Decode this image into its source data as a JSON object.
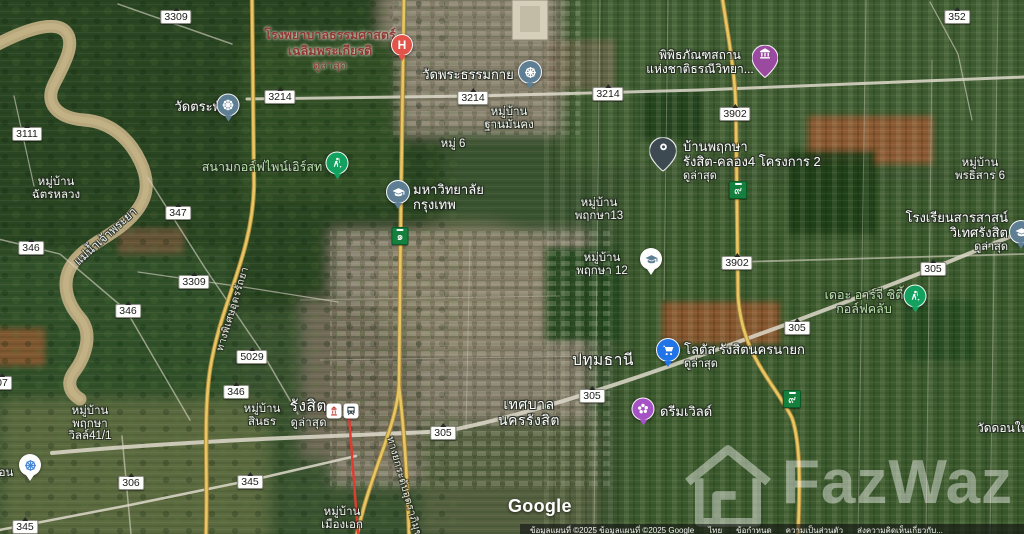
{
  "watermark": {
    "text": "FazWaz",
    "icon": "house-icon"
  },
  "attribution": {
    "logo": "Google",
    "items": [
      {
        "text": "ข้อมูลแผนที่ ©2025 ข้อมูลแผนที่ ©2025 Google",
        "link": false
      },
      {
        "text": "ไทย",
        "link": true
      },
      {
        "text": "ข้อกำหนด",
        "link": true
      },
      {
        "text": "ความเป็นส่วนตัว",
        "link": true
      },
      {
        "text": "ส่งความคิดเห็นเกี่ยวกับ...",
        "link": true
      }
    ]
  },
  "road_shields": [
    {
      "value": "3309",
      "x": 176,
      "y": 17,
      "style": "white"
    },
    {
      "value": "352",
      "x": 957,
      "y": 17,
      "style": "white"
    },
    {
      "value": "3214",
      "x": 280,
      "y": 97,
      "style": "white"
    },
    {
      "value": "3214",
      "x": 473,
      "y": 98,
      "style": "white"
    },
    {
      "value": "3214",
      "x": 608,
      "y": 94,
      "style": "white"
    },
    {
      "value": "3902",
      "x": 735,
      "y": 114,
      "style": "white"
    },
    {
      "value": "3111",
      "x": 27,
      "y": 134,
      "style": "white"
    },
    {
      "value": "๙",
      "x": 738,
      "y": 190,
      "style": "green"
    },
    {
      "value": "347",
      "x": 178,
      "y": 213,
      "style": "white"
    },
    {
      "value": "๑",
      "x": 400,
      "y": 236,
      "style": "green"
    },
    {
      "value": "346",
      "x": 31,
      "y": 248,
      "style": "white"
    },
    {
      "value": "3902",
      "x": 737,
      "y": 263,
      "style": "white"
    },
    {
      "value": "305",
      "x": 933,
      "y": 269,
      "style": "white"
    },
    {
      "value": "3309",
      "x": 194,
      "y": 282,
      "style": "white"
    },
    {
      "value": "346",
      "x": 128,
      "y": 311,
      "style": "white"
    },
    {
      "value": "305",
      "x": 797,
      "y": 328,
      "style": "white"
    },
    {
      "value": "5029",
      "x": 252,
      "y": 357,
      "style": "white"
    },
    {
      "value": "07",
      "x": 2,
      "y": 383,
      "style": "white"
    },
    {
      "value": "346",
      "x": 236,
      "y": 392,
      "style": "white"
    },
    {
      "value": "305",
      "x": 592,
      "y": 396,
      "style": "white"
    },
    {
      "value": "๙",
      "x": 792,
      "y": 399,
      "style": "green"
    },
    {
      "value": "305",
      "x": 443,
      "y": 433,
      "style": "white"
    },
    {
      "value": "306",
      "x": 131,
      "y": 483,
      "style": "white"
    },
    {
      "value": "345",
      "x": 250,
      "y": 482,
      "style": "white"
    },
    {
      "value": "345",
      "x": 25,
      "y": 527,
      "style": "white"
    }
  ],
  "markers": [
    {
      "id": "hospital-marker",
      "icon": "hospital-h-icon",
      "shape": "circle",
      "color": "#e25449",
      "icon_color": "#ffffff",
      "x": 402,
      "y": 45,
      "size": 20
    },
    {
      "id": "museum-marker",
      "icon": "museum-icon",
      "shape": "pin",
      "color": "#9a4ba0",
      "icon_color": "#ffffff",
      "x": 765,
      "y": 60,
      "size": 26
    },
    {
      "id": "dhammakaya-temple-marker",
      "icon": "dharma-wheel-icon",
      "shape": "circle",
      "color": "#5e7f93",
      "icon_color": "#ffffff",
      "x": 530,
      "y": 72,
      "size": 22
    },
    {
      "id": "wat-trapang-marker",
      "icon": "dharma-wheel-icon",
      "shape": "circle",
      "color": "#5e7f93",
      "icon_color": "#ffffff",
      "x": 228,
      "y": 105,
      "size": 21
    },
    {
      "id": "baan-pruksa-pin-marker",
      "icon": "ring-icon",
      "shape": "pin",
      "color": "#3e4a52",
      "icon_color": "#ffffff",
      "x": 663,
      "y": 153,
      "size": 27
    },
    {
      "id": "pinehurst-golf-marker",
      "icon": "golfer-icon",
      "shape": "circle",
      "color": "#12a15e",
      "icon_color": "#ffffff",
      "x": 337,
      "y": 163,
      "size": 21
    },
    {
      "id": "bangkok-university-marker",
      "icon": "graduation-cap-icon",
      "shape": "circle",
      "color": "#5e7f93",
      "icon_color": "#ffffff",
      "x": 398,
      "y": 192,
      "size": 22
    },
    {
      "id": "sarasas-school-marker",
      "icon": "graduation-cap-icon",
      "shape": "circle",
      "color": "#5e7f93",
      "icon_color": "#ffffff",
      "x": 1021,
      "y": 232,
      "size": 22
    },
    {
      "id": "pruksa12-school-marker",
      "icon": "graduation-cap-icon",
      "shape": "circle",
      "color": "#ffffff",
      "icon_color": "#5e7f93",
      "x": 651,
      "y": 259,
      "size": 20
    },
    {
      "id": "rg-city-golf-marker",
      "icon": "golfer-icon",
      "shape": "circle",
      "color": "#12a15e",
      "icon_color": "#ffffff",
      "x": 915,
      "y": 296,
      "size": 21
    },
    {
      "id": "lotus-marker",
      "icon": "cart-icon",
      "shape": "circle",
      "color": "#2173e8",
      "icon_color": "#ffffff",
      "x": 668,
      "y": 350,
      "size": 22
    },
    {
      "id": "dream-world-marker",
      "icon": "flower-icon",
      "shape": "circle",
      "color": "#a552c5",
      "icon_color": "#ffffff",
      "x": 643,
      "y": 409,
      "size": 21
    },
    {
      "id": "rangsit-shrine-marker",
      "icon": "shrine-icon",
      "shape": "square",
      "color": "#ffffff",
      "icon_color": "#c0392b",
      "x": 334,
      "y": 411,
      "size": 15
    },
    {
      "id": "rangsit-station-marker",
      "icon": "train-icon",
      "shape": "square",
      "color": "#ffffff",
      "icon_color": "#37474f",
      "x": 351,
      "y": 411,
      "size": 15
    },
    {
      "id": "wat-left-edge-marker",
      "icon": "dharma-wheel-icon",
      "shape": "circle",
      "color": "#ffffff",
      "icon_color": "#4a87d5",
      "x": 30,
      "y": 465,
      "size": 20
    }
  ],
  "labels": [
    {
      "id": "thammasat-hospital",
      "type": "hospital",
      "x": 330,
      "y": 28,
      "align": "center",
      "lines": [
        "โรงพยาบาลธรรมศาสตร์",
        "เฉลิมพระเกียรติ"
      ],
      "sub": "ดูล่าสุด",
      "interactable": true
    },
    {
      "id": "geology-museum",
      "type": "poi",
      "x": 700,
      "y": 49,
      "align": "center",
      "lines": [
        "พิพิธภัณฑสถาน",
        "แห่งชาติธรณีวิทยา..."
      ],
      "interactable": true
    },
    {
      "id": "wat-phra-dhammakaya",
      "type": "poi13",
      "x": 468,
      "y": 67,
      "align": "center",
      "lines": [
        "วัดพระธรรมกาย"
      ],
      "interactable": true
    },
    {
      "id": "wat-trapang",
      "type": "poi13",
      "x": 201,
      "y": 99,
      "align": "center",
      "lines": [
        "วัดตระพัง"
      ],
      "interactable": true
    },
    {
      "id": "baan-than-mankong",
      "type": "village",
      "x": 509,
      "y": 106,
      "align": "center",
      "lines": [
        "หมู่บ้าน",
        "ฐานมั่นคง"
      ],
      "interactable": false
    },
    {
      "id": "moo-6",
      "type": "village",
      "x": 453,
      "y": 138,
      "align": "center",
      "lines": [
        "หมู่ 6"
      ],
      "interactable": false
    },
    {
      "id": "baan-pruksa-rangsit",
      "type": "poi13",
      "x": 683,
      "y": 139,
      "align": "left",
      "lines": [
        "บ้านพฤกษา",
        "รังสิต-คลอง4 โครงการ 2"
      ],
      "sub": "ดูล่าสุด",
      "interactable": true
    },
    {
      "id": "pornthisan-6",
      "type": "village",
      "x": 980,
      "y": 157,
      "align": "center",
      "lines": [
        "หมู่บ้าน",
        "พรธิสาร 6"
      ],
      "interactable": false
    },
    {
      "id": "pinehurst-golf",
      "type": "golf",
      "x": 262,
      "y": 160,
      "align": "center",
      "lines": [
        "สนามกอล์ฟไพน์เอิร์สท"
      ],
      "interactable": true
    },
    {
      "id": "chat-luang",
      "type": "village",
      "x": 56,
      "y": 176,
      "align": "center",
      "lines": [
        "หมู่บ้าน",
        "ฉัตรหลวง"
      ],
      "interactable": false
    },
    {
      "id": "bangkok-university",
      "type": "poi13",
      "x": 413,
      "y": 182,
      "align": "left",
      "lines": [
        "มหาวิทยาลัย",
        "กรุงเทพ"
      ],
      "interactable": true
    },
    {
      "id": "pruksa-13",
      "type": "village",
      "x": 599,
      "y": 197,
      "align": "center",
      "lines": [
        "หมู่บ้าน",
        "พฤกษา13"
      ],
      "interactable": false
    },
    {
      "id": "sarasas-school",
      "type": "poi13",
      "x": 1008,
      "y": 210,
      "align": "right",
      "lines": [
        "โรงเรียนสารสาสน์",
        "วิเทศรังสิต"
      ],
      "sub": "ดูล่าสุด",
      "interactable": true
    },
    {
      "id": "chao-phraya-river",
      "type": "water",
      "x": 106,
      "y": 237,
      "align": "center",
      "rot": -42,
      "lines": [
        "แม่น้ำเจ้าพระยา"
      ],
      "interactable": false
    },
    {
      "id": "pruksa-12",
      "type": "village",
      "x": 602,
      "y": 252,
      "align": "center",
      "lines": [
        "หมู่บ้าน",
        "พฤกษา 12"
      ],
      "interactable": false
    },
    {
      "id": "rg-city-golf",
      "type": "golf",
      "x": 864,
      "y": 288,
      "align": "center",
      "lines": [
        "เดอะ อาร์จี ซิตี้",
        "กอล์ฟคลับ"
      ],
      "interactable": true
    },
    {
      "id": "udon-ratthaya-expwy",
      "type": "roadname",
      "x": 233,
      "y": 309,
      "align": "center",
      "rot": -73,
      "lines": [
        "ทางพิเศษอุดรรัถยา"
      ],
      "interactable": false
    },
    {
      "id": "lotus-rangsit",
      "type": "poi13",
      "x": 684,
      "y": 342,
      "align": "left",
      "lines": [
        "โลตัส รังสิตนครนายก"
      ],
      "sub": "ดูล่าสุด",
      "interactable": true
    },
    {
      "id": "pathum-thani",
      "type": "city",
      "x": 603,
      "y": 352,
      "align": "center",
      "lines": [
        "ปทุมธานี"
      ],
      "interactable": false
    },
    {
      "id": "rangsit-city",
      "type": "city",
      "x": 327,
      "y": 398,
      "align": "right",
      "lines": [
        "รังสิต"
      ],
      "sub": "ดูล่าสุด",
      "interactable": true
    },
    {
      "id": "rangsit-municipality",
      "type": "town",
      "x": 529,
      "y": 396,
      "align": "center",
      "lines": [
        "เทศบาล",
        "นครรังสิต"
      ],
      "interactable": false
    },
    {
      "id": "sinthorn-village",
      "type": "village",
      "x": 262,
      "y": 403,
      "align": "center",
      "lines": [
        "หมู่บ้าน",
        "สินธร"
      ],
      "interactable": false
    },
    {
      "id": "dream-world",
      "type": "poi13",
      "x": 660,
      "y": 404,
      "align": "left",
      "lines": [
        "ดรีมเวิลด์"
      ],
      "interactable": true
    },
    {
      "id": "pruksa-ville-41-1",
      "type": "village",
      "x": 90,
      "y": 405,
      "align": "center",
      "lines": [
        "หมู่บ้าน",
        "พฤกษา",
        "วิลล์41/1"
      ],
      "interactable": false
    },
    {
      "id": "wat-don-yai",
      "type": "poi",
      "x": 977,
      "y": 422,
      "align": "left",
      "lines": [
        "วัดดอนใหญ่"
      ],
      "interactable": true
    },
    {
      "id": "left-edge-fragment",
      "type": "village",
      "x": 6,
      "y": 467,
      "align": "center",
      "lines": [
        "อน"
      ],
      "interactable": false
    },
    {
      "id": "uttaraphimuk-tollway",
      "type": "roadname",
      "x": 404,
      "y": 487,
      "align": "center",
      "rot": 74,
      "lines": [
        "ทางยกระดับอุตราภิมุข"
      ],
      "interactable": false
    },
    {
      "id": "muang-ake",
      "type": "village",
      "x": 342,
      "y": 506,
      "align": "center",
      "lines": [
        "หมู่บ้าน",
        "เมืองเอก"
      ],
      "interactable": false
    }
  ]
}
